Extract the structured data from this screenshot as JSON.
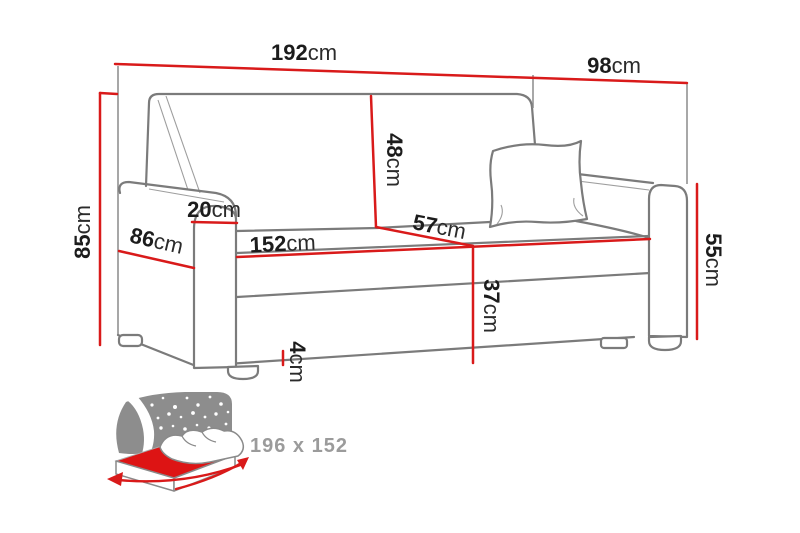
{
  "dimensions": {
    "total_width": {
      "value": "192",
      "unit": "cm"
    },
    "total_depth": {
      "value": "98",
      "unit": "cm"
    },
    "total_height": {
      "value": "85",
      "unit": "cm"
    },
    "side_depth": {
      "value": "86",
      "unit": "cm"
    },
    "armrest_width": {
      "value": "20",
      "unit": "cm"
    },
    "backrest_height": {
      "value": "48",
      "unit": "cm"
    },
    "seat_width": {
      "value": "152",
      "unit": "cm"
    },
    "seat_depth": {
      "value": "57",
      "unit": "cm"
    },
    "seat_height": {
      "value": "37",
      "unit": "cm"
    },
    "leg_height": {
      "value": "4",
      "unit": "cm"
    },
    "armrest_height": {
      "value": "55",
      "unit": "cm"
    }
  },
  "sleeping_area": {
    "label": "196 x 152"
  },
  "colors": {
    "dimension_red": "#d91a1a",
    "outline_gray": "#7b7b7b",
    "icon_gray": "#8d8d8d",
    "icon_label_gray": "#9b9b9b",
    "label_text": "#1c1c1c",
    "mattress_red": "#dd1414"
  }
}
